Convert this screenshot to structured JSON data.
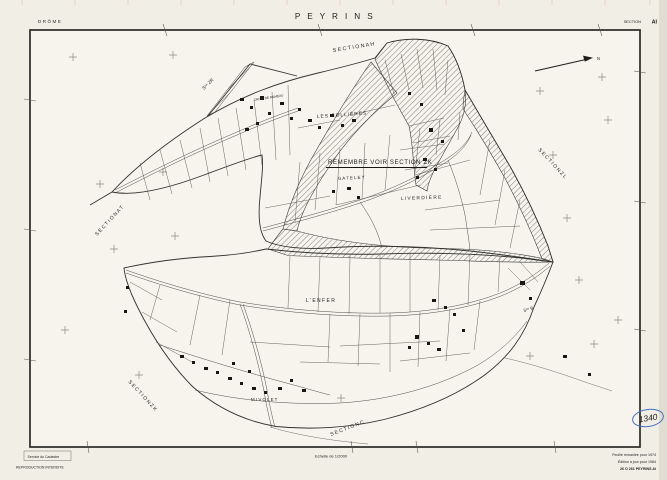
{
  "colors": {
    "paper": "#f1eee6",
    "map_paper": "#f6f4ed",
    "ink": "#2a2a26",
    "parcel_line": "#55534c",
    "cross": "#8b8b7d",
    "blue_ink": "#4472c0"
  },
  "header": {
    "department": "DRÔME",
    "commune": "P E Y R I N S",
    "section_word": "SECTION",
    "section_code": "AI"
  },
  "map": {
    "north_mark": "N",
    "annotation": "REMEMBRE  VOIR  SECTION  ZK",
    "sections": {
      "ah": "S E C T I O N    A H",
      "zr": "Sᵒⁿ  ZR",
      "at": "S E C T I O N    A T",
      "zl": "S E C T I O N    Z L",
      "zk": "S E C T I O N    Z K",
      "c": "S E C T I O N      C",
      "b": "Sᵒⁿ B"
    },
    "places": {
      "croix_de_rameau": "CROIX  DE  RAMEAU",
      "les_collieres": "LES  COLLIÈRES",
      "gateley": "G A T E L E Y",
      "liverdiere": "L I V E R D I È R E",
      "l_enfer": "L ' E N F E R",
      "mivolet": "M I V O L E T"
    },
    "handwritten_number": "1340"
  },
  "footer": {
    "issuer": "Service du Cadastre",
    "copyright": "REPRODUCTION  INTERDITE",
    "scale": "Echelle de 1/2000",
    "edition_lines": [
      "Feuille remaniée pour 1974",
      "Édition à jour pour 1984",
      "26 O 261  PEYRINS  AI"
    ]
  }
}
